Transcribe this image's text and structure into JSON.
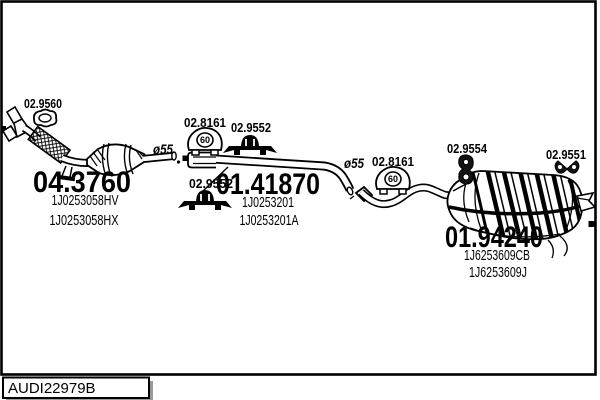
{
  "page": {
    "background": "#ffffff",
    "ink": "#000000",
    "shadow_gray": "#9a9a9a"
  },
  "parts": {
    "front_pipe": {
      "ref": "04.3760",
      "oem_codes": [
        "1J0253058HV",
        "1J0253058HX"
      ],
      "gasket_ref": "02.9560",
      "pipe_diameter": "ø55"
    },
    "centre_pipe": {
      "ref": "01.41870",
      "oem_codes": [
        "1J0253201",
        "1J0253201A"
      ],
      "rubber_mount_ref": "02.8161",
      "rubber_mount_size": "60",
      "bracket_ref_upper": "02.9552",
      "bracket_ref_lower": "02.9552",
      "pipe_diameter": "ø55"
    },
    "rear_muffler": {
      "ref": "01.94240",
      "oem_codes": [
        "1J6253609CB",
        "1J6253609J"
      ],
      "rubber_mount_ref": "02.8161",
      "rubber_mount_size": "60",
      "hanger_ref": "02.9554",
      "hanger_ref_rear": "02.9551"
    }
  },
  "footer": {
    "drawing_code": "AUDI22979B"
  }
}
